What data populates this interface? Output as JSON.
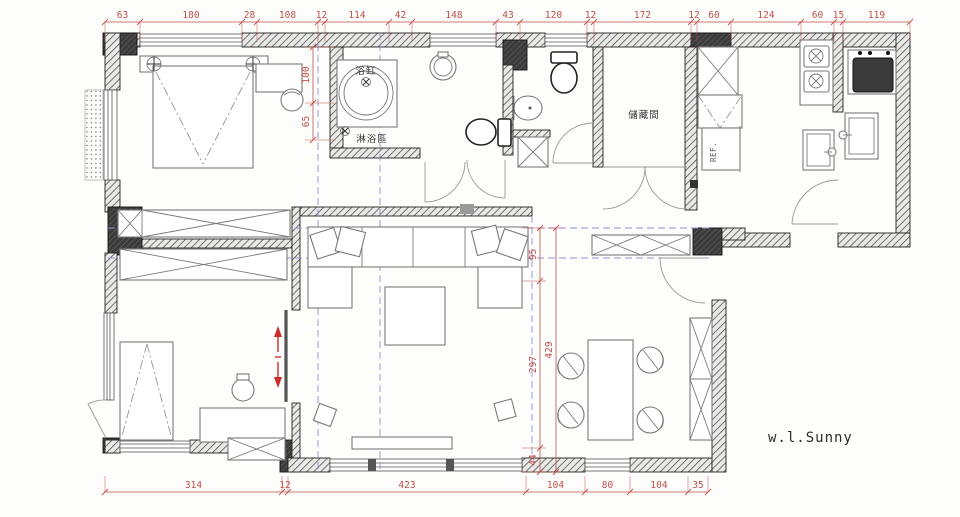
{
  "drawing": {
    "type": "residential-floor-plan",
    "signature": "w.l.Sunny",
    "rooms": {
      "bathtub_label": "浴缸",
      "shower_label": "淋浴區",
      "storage_label": "儲藏間",
      "fridge_label": "REF."
    },
    "colors": {
      "dimension_red": "#c0504a",
      "projection_blue": "#8f8fd0",
      "wall_hatch": "#4a4a4a",
      "fixture_gray": "#7a7a7a",
      "arrow_red": "#cc2b2b"
    },
    "dimensions": {
      "top": [
        "63",
        "180",
        "28",
        "108",
        "12",
        "114",
        "42",
        "148",
        "43",
        "120",
        "12",
        "172",
        "12",
        "60",
        "124",
        "60",
        "15",
        "119"
      ],
      "bottom": [
        "314",
        "12",
        "423",
        "104",
        "80",
        "104",
        "35"
      ],
      "left": [
        "100",
        "65"
      ],
      "right_inner": [
        "95",
        "297",
        "44"
      ],
      "right_outer": [
        "429"
      ]
    }
  }
}
